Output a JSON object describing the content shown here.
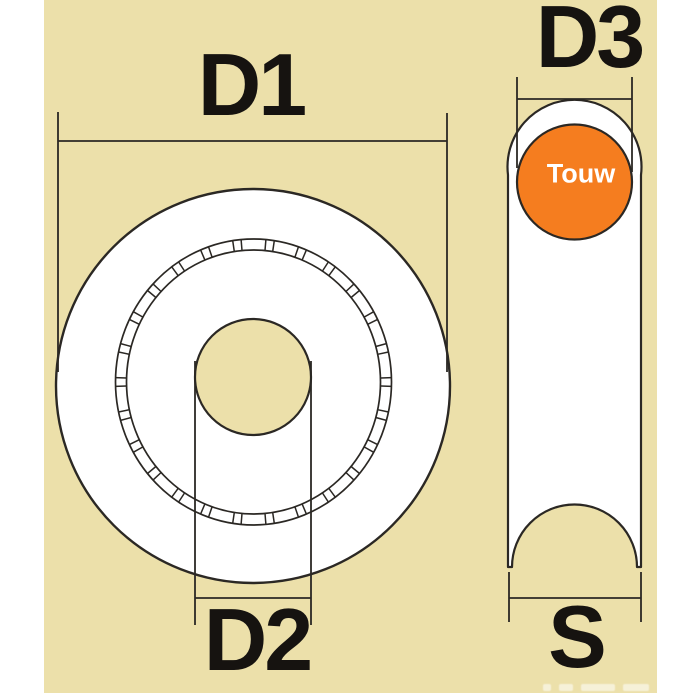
{
  "colors": {
    "page_bg": "#ffffff",
    "panel_bg": "#ece0aa",
    "outline": "#2b2824",
    "label_text": "#161310",
    "rope_fill": "#f57d1f",
    "rope_text": "#ffffff"
  },
  "labels": {
    "d1": "D1",
    "d2": "D2",
    "d3": "D3",
    "s": "S",
    "rope": "Touw"
  }
}
